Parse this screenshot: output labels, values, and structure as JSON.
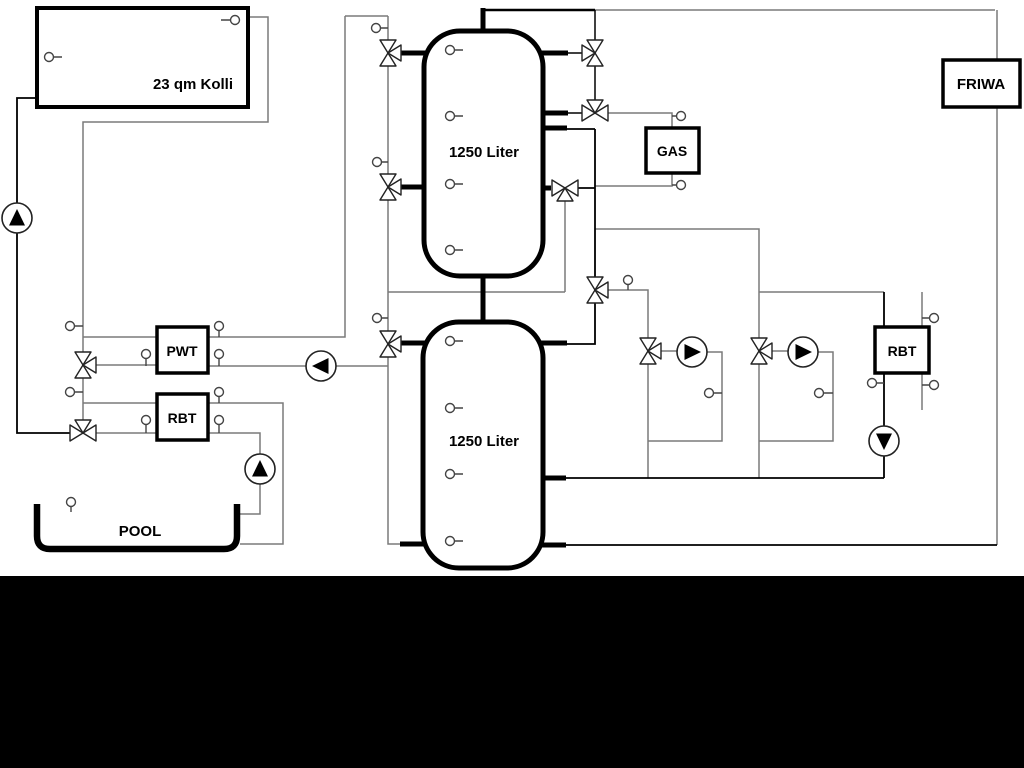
{
  "diagram": {
    "background_color": "#ffffff",
    "letterbox_color": "#000000",
    "pipe_color_primary": "#000000",
    "pipe_color_secondary": "#7a7a7a",
    "labels": {
      "collector": "23 qm Kolli",
      "tank_upper": "1250 Liter",
      "tank_lower": "1250 Liter",
      "pwt": "PWT",
      "rbt_solar": "RBT",
      "gas": "GAS",
      "friwa": "FRIWA",
      "rbt_heating": "RBT",
      "pool": "POOL"
    },
    "pumps": [
      {
        "name": "solar-pump",
        "direction": "up"
      },
      {
        "name": "tank-charge-pump",
        "direction": "left"
      },
      {
        "name": "pool-pump",
        "direction": "up"
      },
      {
        "name": "heating-circuit-pump-1",
        "direction": "right"
      },
      {
        "name": "heating-circuit-pump-2",
        "direction": "right"
      },
      {
        "name": "rbt-heating-pump",
        "direction": "down"
      }
    ],
    "three_way_valve_count": 11,
    "sensor_count": 30
  }
}
